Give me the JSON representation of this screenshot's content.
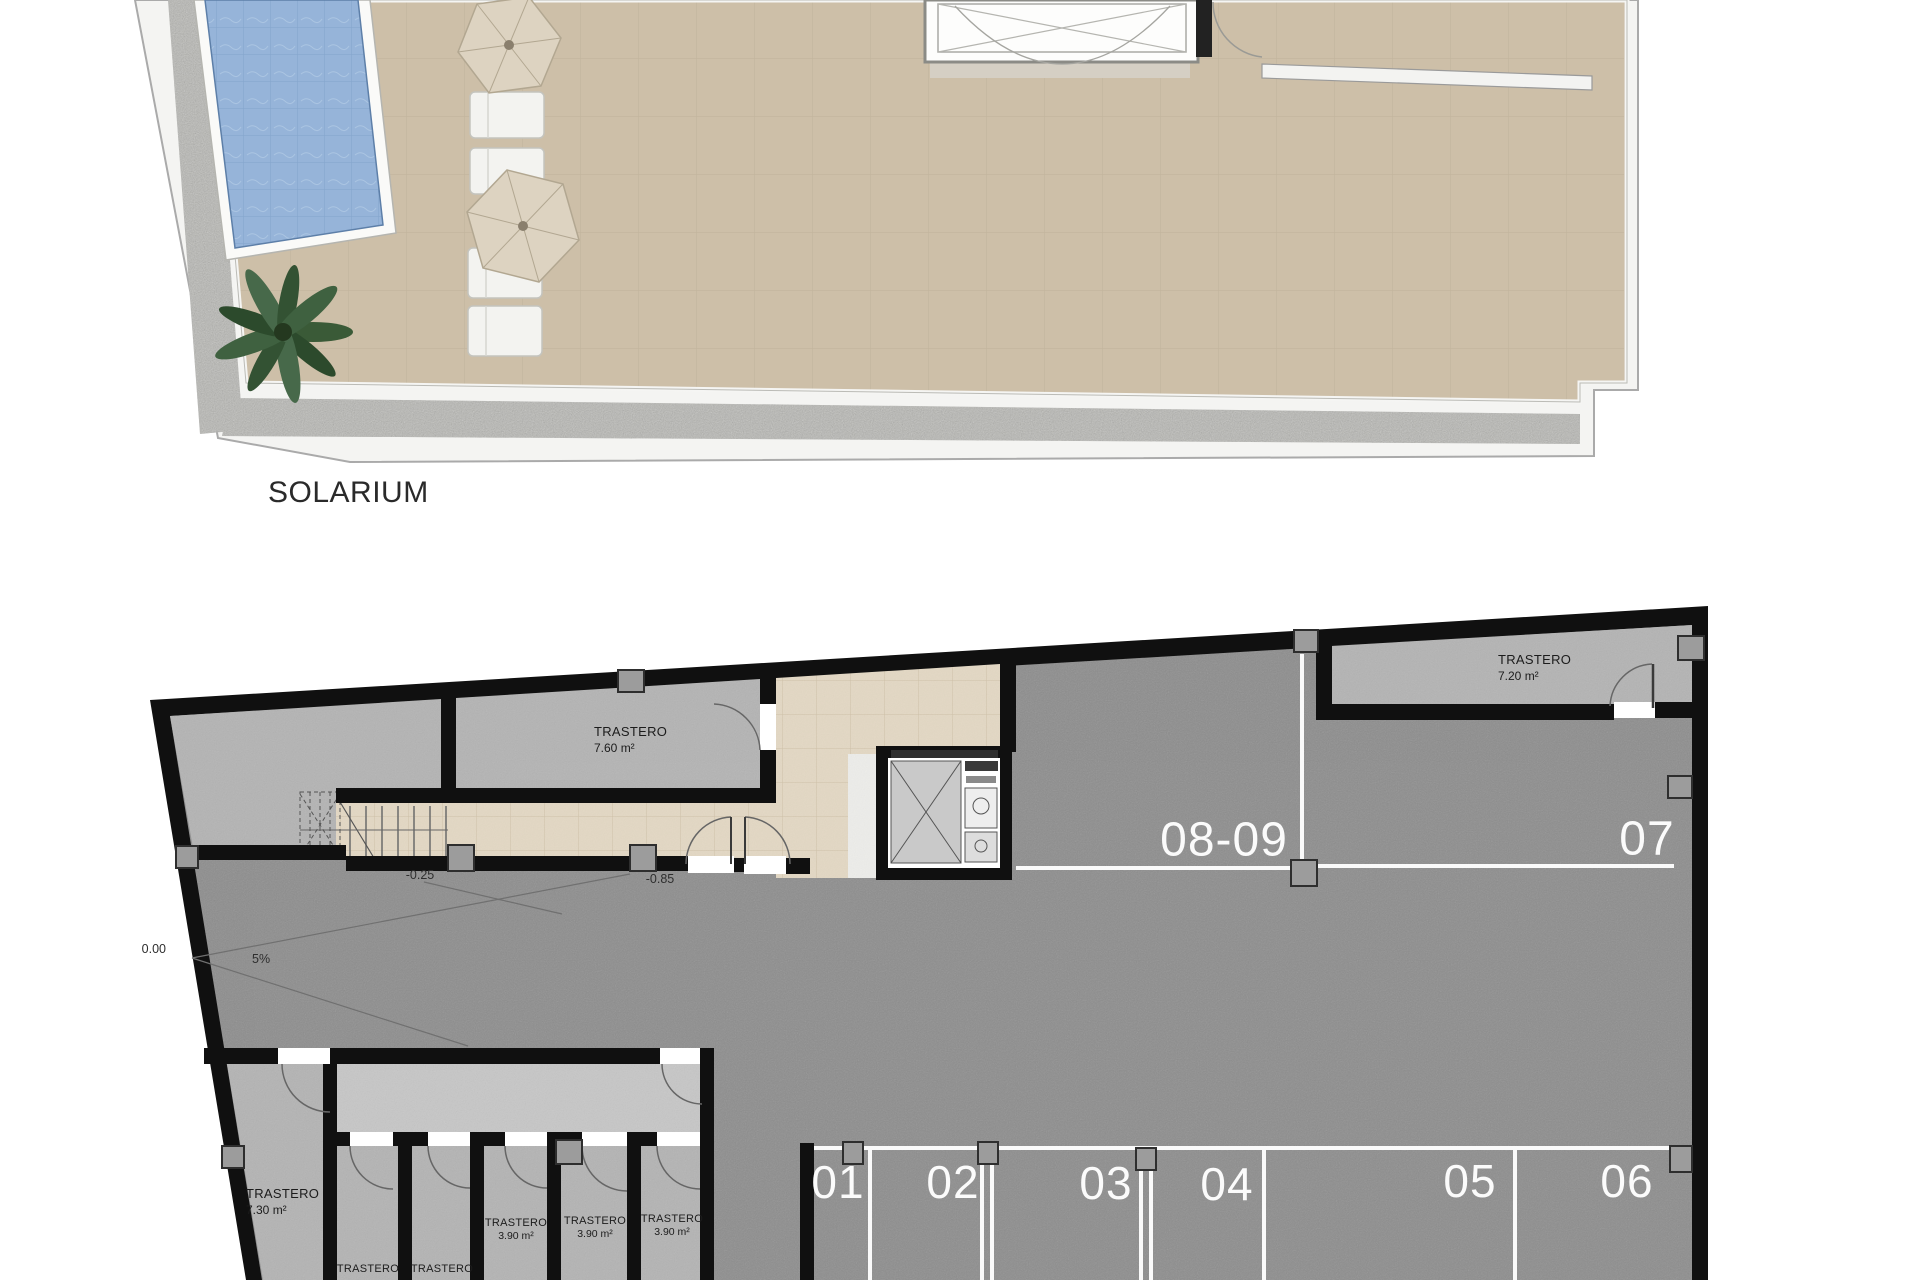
{
  "floor_labels": {
    "solarium": "SOLARIUM"
  },
  "storage": {
    "t760": {
      "name": "TRASTERO",
      "area": "7.60 m²"
    },
    "t720": {
      "name": "TRASTERO",
      "area": "7.20 m²"
    },
    "t730": {
      "name": "TRASTERO",
      "area": "7.30 m²"
    },
    "cell1": {
      "name": "TRASTERO"
    },
    "cell2": {
      "name": "TRASTERO"
    },
    "cell3": {
      "name": "TRASTERO",
      "area": "3.90 m²"
    },
    "cell4": {
      "name": "TRASTERO",
      "area": "3.90 m²"
    },
    "cell5": {
      "name": "TRASTERO",
      "area": "3.90 m²"
    }
  },
  "parking": {
    "p01": "01",
    "p02": "02",
    "p03": "03",
    "p04": "04",
    "p05": "05",
    "p06": "06",
    "p07": "07",
    "p0809": "08-09"
  },
  "levels": {
    "entry": "0.00",
    "slope": "5%",
    "landing": "-0.25",
    "garage": "-0.85"
  },
  "colors": {
    "deck": "#cdbfa8",
    "pool": "#96b4d9",
    "garage_floor": "#8d8d8d",
    "room_gray": "#b4b4b4",
    "corridor_gray": "#c7c7c7",
    "tile_beige": "#e3d8c4",
    "wall": "#101010",
    "parking_line": "#fafafa"
  }
}
